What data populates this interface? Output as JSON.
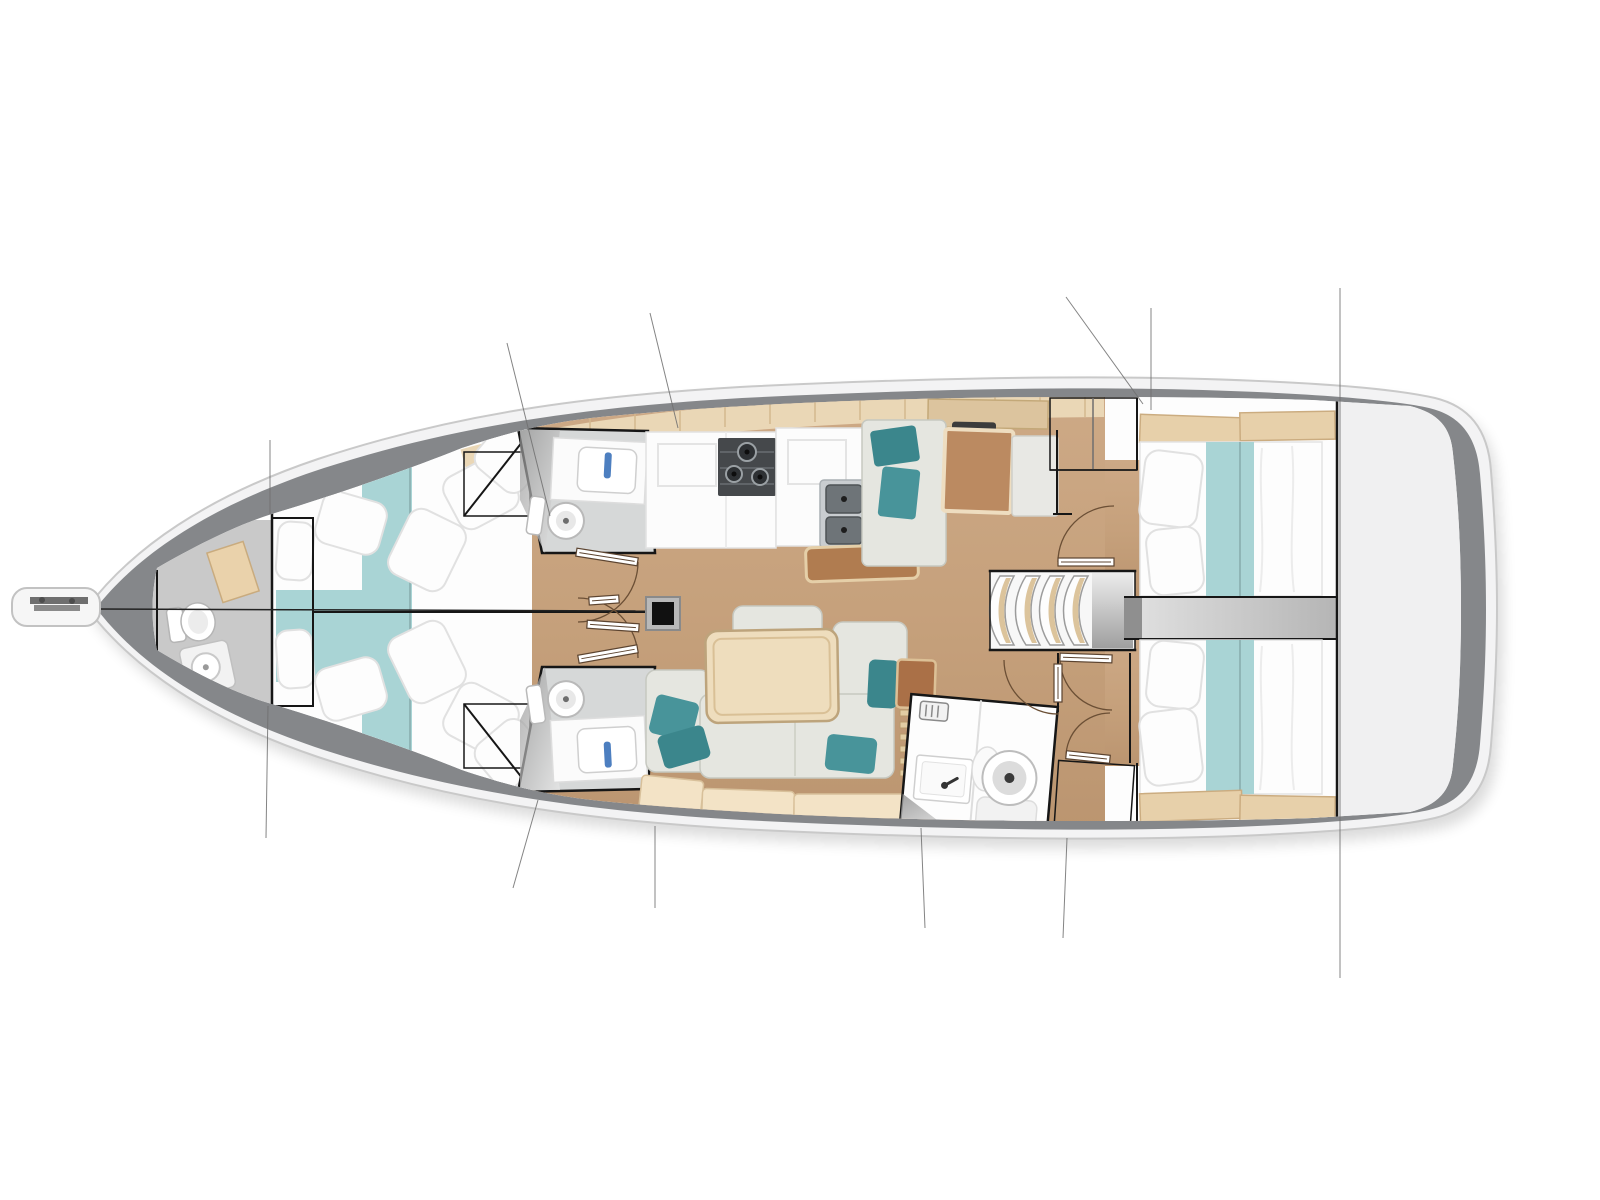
{
  "page": {
    "background": "#ffffff",
    "description": "Top-down interior layout plan of a sailing yacht, bow pointing left, no text labels",
    "image_type": "boat floor plan illustration"
  },
  "palette": {
    "hull_fill": "#f3f3f4",
    "hull_stroke": "#c9c9c9",
    "deck_band": "#85878a",
    "interior": "#ffffff",
    "bow_floor": "#c9c9c9",
    "wood_floor": "#c6a17c",
    "plank_trim": "#ead7b6",
    "plank_tick": "#d3b88e",
    "bed_white": "#fdfdfd",
    "pillow_stroke": "#e1e1e1",
    "aqua": "#a9d4d5",
    "aqua_edge": "#8fb5b6",
    "head_floor": "#d6d8d8",
    "faucet_blue": "#4d7fc0",
    "stove_dark": "#45484b",
    "steel_light": "#c9cdd0",
    "steel_dark": "#6e7478",
    "counter_white": "#fcfcfc",
    "bench_brown": "#b07c50",
    "bench_border": "#e5cfa8",
    "seat_brown": "#bb8a61",
    "seat_gray": "#e5e6e0",
    "seat_stroke": "#c6c8c0",
    "teal_dark": "#3b868c",
    "teal_mid": "#48949a",
    "table_wood": "#eeddbd",
    "table_border": "#bda47c",
    "pale_bench": "#f3e3c6",
    "pale_bench_border": "#d8c09a",
    "wardrobe_gray": "#9b9b9b",
    "line_black": "#161616",
    "door_line": "#6b4f35",
    "rigging": "#6f6f6f",
    "locker_tan": "#ead2ab",
    "headboard_tan": "#e7d0aa",
    "headboard_border": "#cbac80",
    "aft_deck": "#f0f0f1",
    "mast_frame": "#b9b9b9",
    "mast_black": "#111111"
  },
  "rooms": [
    {
      "id": "bowsprit",
      "name": "bowsprit with anchor roller"
    },
    {
      "id": "bow-head",
      "name": "forepeak head with toilet and shower"
    },
    {
      "id": "forward-cabins",
      "name": "twin forward double cabins with aqua bed runners"
    },
    {
      "id": "head-starboard",
      "name": "starboard midship head with sink and toilet"
    },
    {
      "id": "head-port",
      "name": "port midship head with sink and toilet"
    },
    {
      "id": "galley",
      "name": "galley with stove, double sink and island bench"
    },
    {
      "id": "nav-station",
      "name": "navigation station with chart seat and table"
    },
    {
      "id": "salon",
      "name": "salon with dining table and L-settee"
    },
    {
      "id": "companionway",
      "name": "companionway steps"
    },
    {
      "id": "aft-head",
      "name": "aft head with sink and round toilet"
    },
    {
      "id": "aft-cabin-starboard",
      "name": "starboard aft double cabin"
    },
    {
      "id": "aft-cabin-port",
      "name": "port aft double cabin"
    },
    {
      "id": "engine-corridor",
      "name": "engine compartment corridor between aft cabins"
    },
    {
      "id": "aft-deck",
      "name": "aft deck / cockpit area"
    }
  ],
  "fixture_icons": [
    "anchor-roller-icon",
    "toilet-icon",
    "shower-icon",
    "sink-icon",
    "faucet-icon",
    "stove-burner-icon",
    "double-sink-icon",
    "vent-icon",
    "mast-step-icon",
    "hanging-clothes-icon",
    "door-swing-arc",
    "step-slat"
  ],
  "counts": {
    "cabins": 4,
    "heads": 4,
    "companionway_steps": 4,
    "stove_burners": 3,
    "galley_sink_basins": 2
  },
  "rigging_lines": [
    {
      "x1": 270,
      "y1": 440,
      "x2": 270,
      "y2": 514
    },
    {
      "x1": 268,
      "y1": 706,
      "x2": 266,
      "y2": 838
    },
    {
      "x1": 507,
      "y1": 343,
      "x2": 550,
      "y2": 516
    },
    {
      "x1": 538,
      "y1": 800,
      "x2": 513,
      "y2": 888
    },
    {
      "x1": 650,
      "y1": 313,
      "x2": 678,
      "y2": 428
    },
    {
      "x1": 655,
      "y1": 826,
      "x2": 655,
      "y2": 908
    },
    {
      "x1": 1066,
      "y1": 297,
      "x2": 1143,
      "y2": 404
    },
    {
      "x1": 1151,
      "y1": 308,
      "x2": 1151,
      "y2": 410
    },
    {
      "x1": 921,
      "y1": 828,
      "x2": 925,
      "y2": 928
    },
    {
      "x1": 1067,
      "y1": 838,
      "x2": 1063,
      "y2": 938
    },
    {
      "x1": 1340,
      "y1": 288,
      "x2": 1340,
      "y2": 978
    }
  ]
}
